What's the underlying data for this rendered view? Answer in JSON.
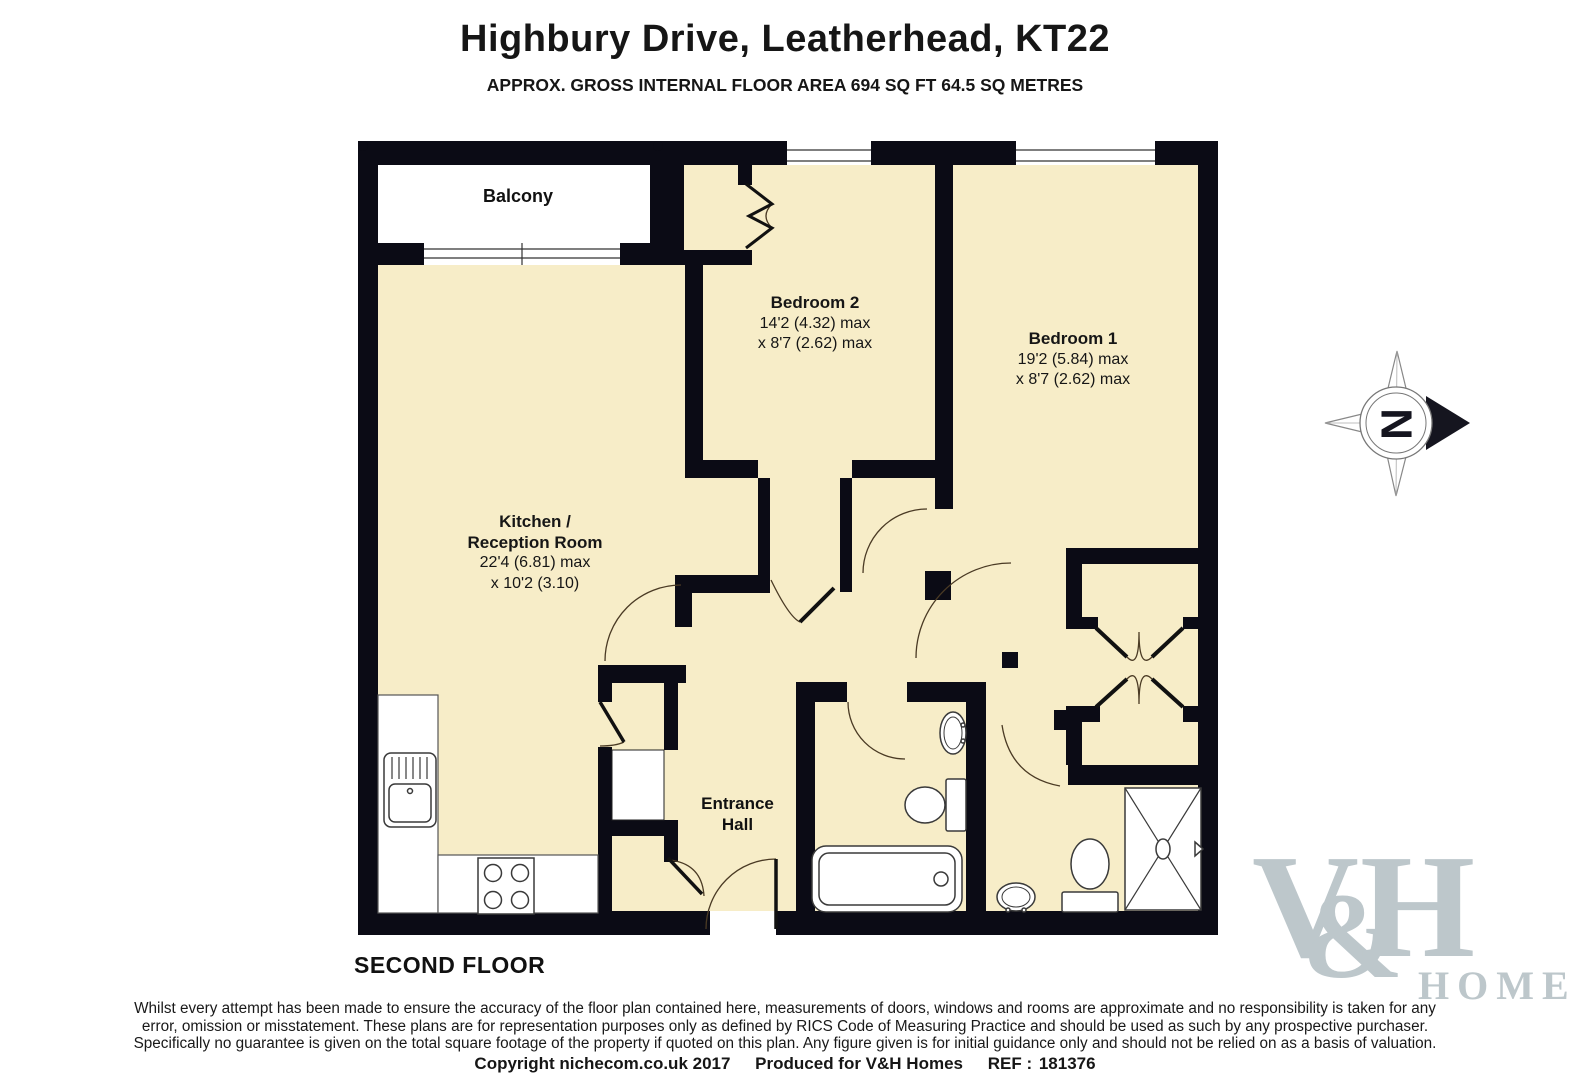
{
  "header": {
    "title": "Highbury Drive, Leatherhead, KT22",
    "subtitle": "APPROX. GROSS INTERNAL FLOOR AREA 694 SQ FT 64.5 SQ METRES"
  },
  "floor_label": "SECOND FLOOR",
  "rooms": {
    "balcony": {
      "name": "Balcony"
    },
    "bedroom2": {
      "name": "Bedroom 2",
      "dims": [
        "14'2 (4.32) max",
        "x 8'7 (2.62) max"
      ]
    },
    "bedroom1": {
      "name": "Bedroom 1",
      "dims": [
        "19'2 (5.84) max",
        "x 8'7 (2.62) max"
      ]
    },
    "kitchen": {
      "name_line1": "Kitchen /",
      "name_line2": "Reception Room",
      "dims": [
        "22'4 (6.81) max",
        "x 10'2 (3.10)"
      ]
    },
    "hall": {
      "name_line1": "Entrance",
      "name_line2": "Hall"
    }
  },
  "compass": {
    "letter": "N"
  },
  "disclaimer": {
    "line1": "Whilst every attempt has been made to ensure the accuracy of the floor plan contained here, measurements of doors, windows and rooms are approximate and no responsibility is taken for any",
    "line2": "error, omission or misstatement. These plans are for representation purposes only as defined by RICS Code of Measuring Practice and should be used as such by any prospective purchaser.",
    "line3": "Specifically no guarantee is given on the total square footage of the property if quoted on this plan. Any figure given is for initial guidance only and should not be relied on as a basis of valuation."
  },
  "footer": {
    "copyright": "Copyright nichecom.co.uk 2017",
    "produced": "Produced for V&H Homes",
    "ref_label": "REF :",
    "ref_value": "181376"
  },
  "logo": {
    "v": "V",
    "amp": "&",
    "h": "H",
    "homes": "HOMES"
  },
  "colors": {
    "room_fill": "#f7edc8",
    "wall": "#0b0b15",
    "balcony_fill": "#ffffff",
    "logo": "#bdc7cb",
    "door_arc": "#4a3a24"
  }
}
